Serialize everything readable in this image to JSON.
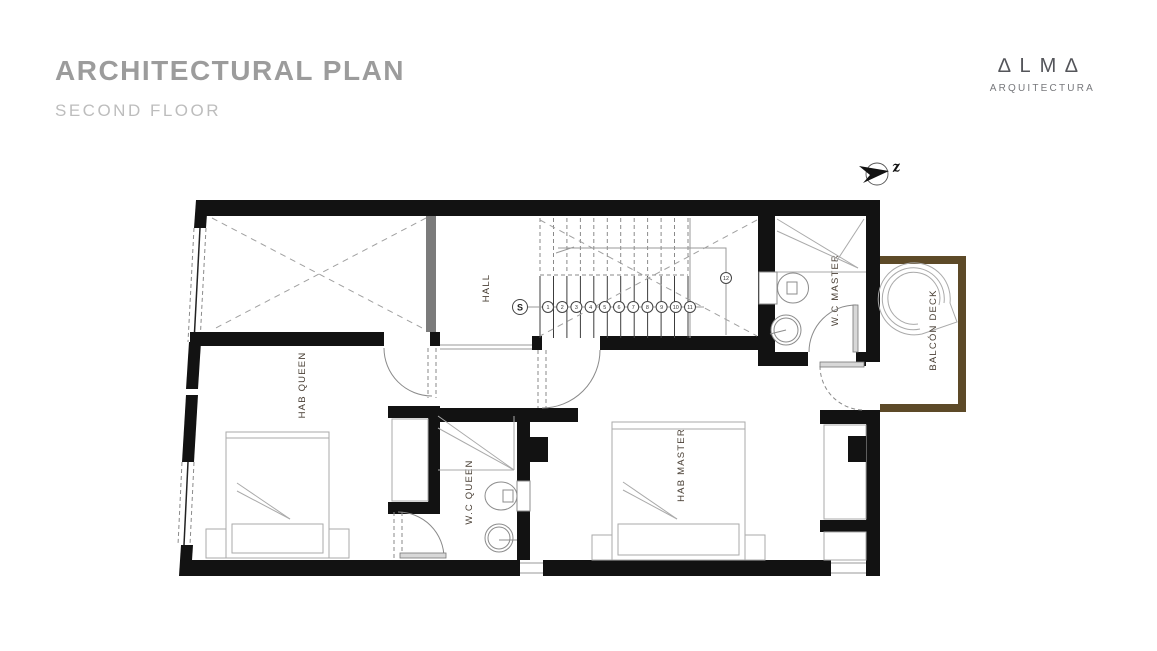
{
  "header": {
    "title": "ARCHITECTURAL PLAN",
    "subtitle": "SECOND FLOOR"
  },
  "logo": {
    "wordmark": "∆LM∆",
    "tagline": "ARQUITECTURA"
  },
  "compass": {
    "north_label": "z"
  },
  "plan": {
    "rooms": {
      "hall": "HALL",
      "hab_queen": "HAB QUEEN",
      "wc_queen": "W.C QUEEN",
      "hab_master": "HAB MASTER",
      "wc_master": "W.C MASTER",
      "balcon_deck": "BALCÓN DECK"
    },
    "stairs": {
      "start": "S",
      "steps": [
        "1",
        "2",
        "3",
        "4",
        "5",
        "6",
        "7",
        "8",
        "9",
        "10",
        "11",
        "12"
      ]
    },
    "colors": {
      "wall": "#121212",
      "interior_wall_gray": "#7b7b7b",
      "balcony_wall": "#5d4a28",
      "label_text": "#4a4036",
      "furniture_line": "#aaaaaa",
      "title_gray": "#9c9c9c"
    }
  }
}
